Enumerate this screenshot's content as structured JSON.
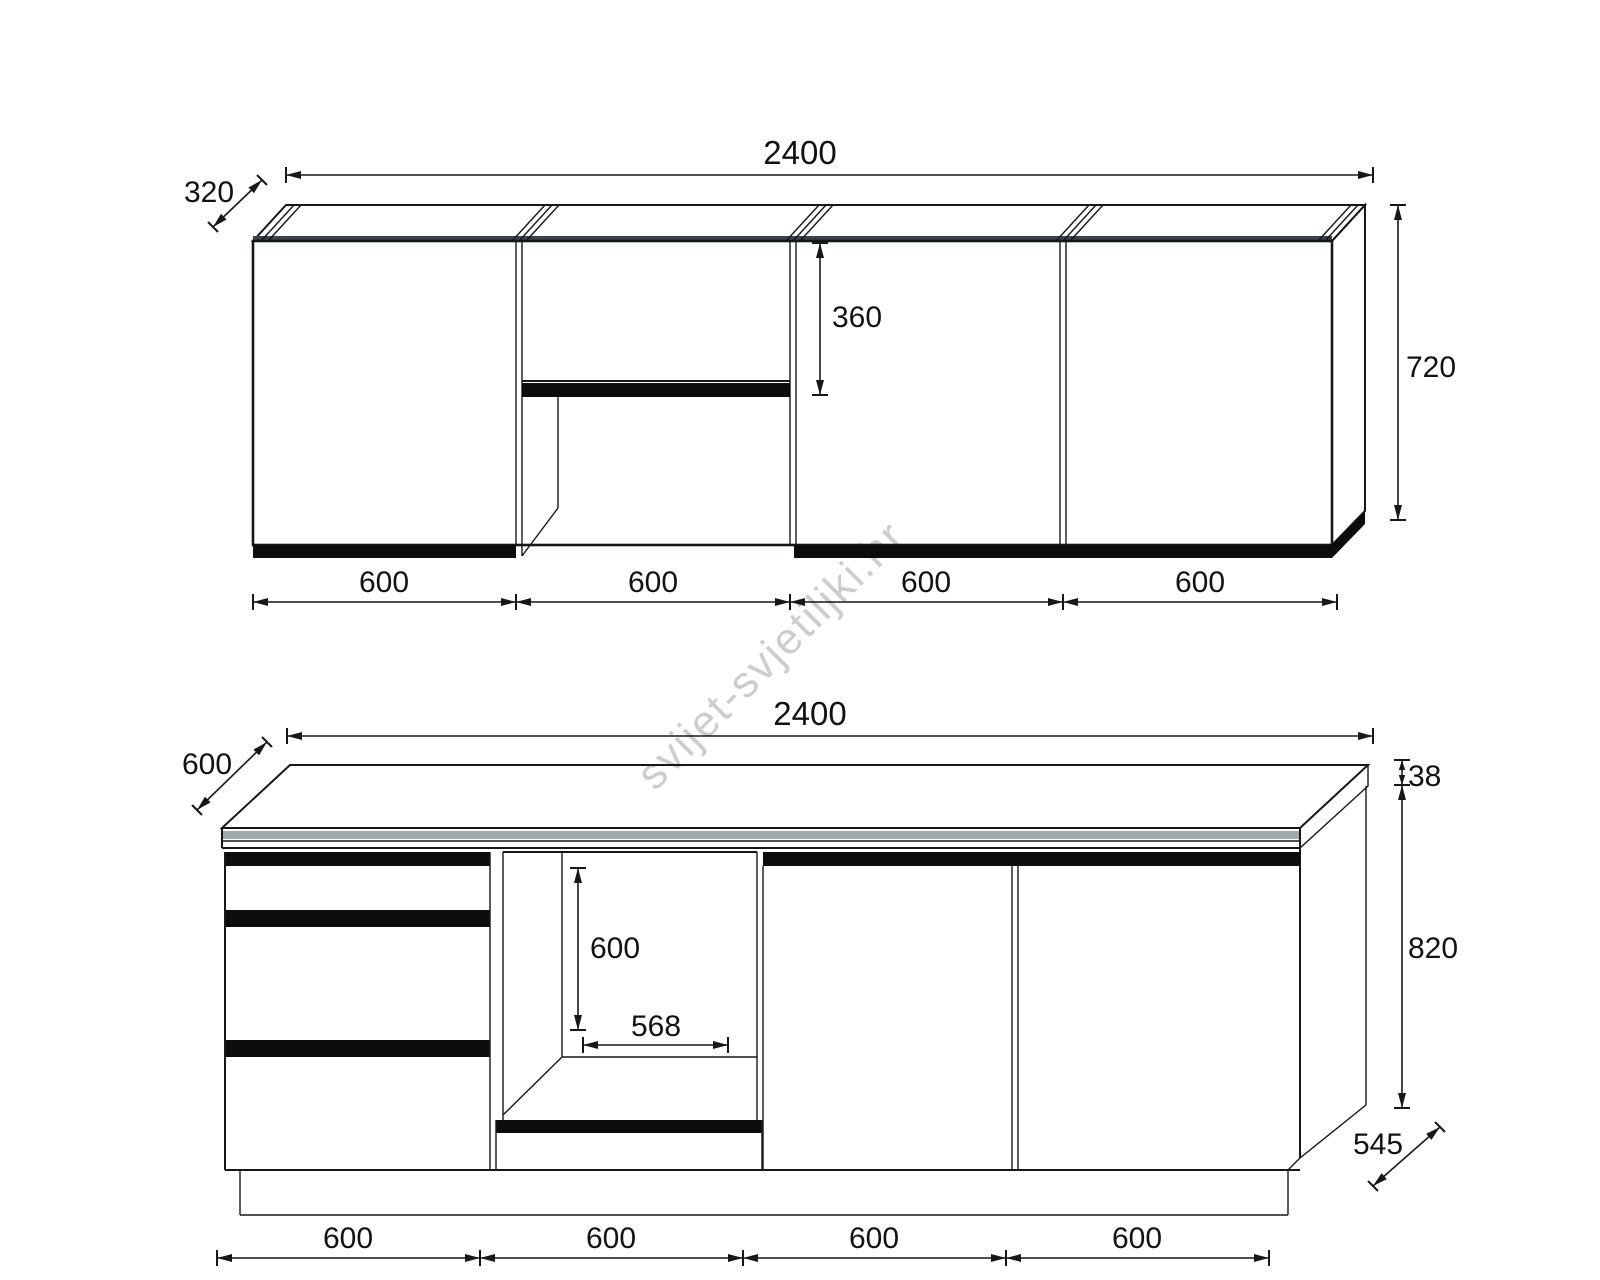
{
  "watermark": {
    "text": "svijet-svjetiljki.hr",
    "color": "#c5c5c5"
  },
  "upper_cabinet_view": {
    "name": "upper-wall-cabinets",
    "total_width": "2400",
    "depth": "320",
    "height": "720",
    "mid_door_height": "360",
    "sections": [
      "600",
      "600",
      "600",
      "600"
    ]
  },
  "base_cabinet_view": {
    "name": "base-cabinets",
    "total_width": "2400",
    "countertop_depth": "600",
    "countertop_thickness": "38",
    "body_height": "820",
    "body_depth": "545",
    "niche_height": "600",
    "niche_width": "568",
    "sections": [
      "600",
      "600",
      "600",
      "600"
    ]
  },
  "colors": {
    "line": "#15181a",
    "fill_black": "#0c0c0c",
    "edge_band": "#9fa8ad",
    "background": "#ffffff"
  }
}
